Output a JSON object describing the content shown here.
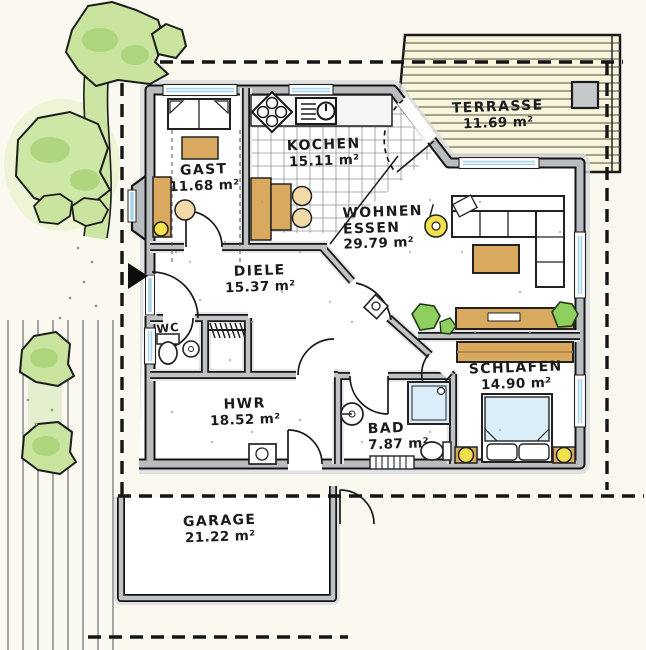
{
  "document": {
    "type": "architectural floor plan, hand-drawn marker style",
    "language": "de"
  },
  "rooms": [
    {
      "id": "terrasse",
      "label": "TERRASSE",
      "area": "11.69 m²"
    },
    {
      "id": "kochen",
      "label": "KOCHEN",
      "area": "15.11 m²"
    },
    {
      "id": "gast",
      "label": "GAST",
      "area": "11.68 m²"
    },
    {
      "id": "wohnen-essen",
      "label1": "WOHNEN /",
      "label2": "ESSEN",
      "area": "29.79 m²"
    },
    {
      "id": "diele",
      "label": "DIELE",
      "area": "15.37 m²"
    },
    {
      "id": "wc",
      "label": "WC"
    },
    {
      "id": "schlafen",
      "label": "SCHLAFEN",
      "area": "14.90 m²"
    },
    {
      "id": "hwr",
      "label": "HWR",
      "area": "18.52 m²"
    },
    {
      "id": "bad",
      "label": "BAD",
      "area": "7.87 m²"
    },
    {
      "id": "garage",
      "label": "GARAGE",
      "area": "21.22 m²"
    }
  ],
  "icons": [
    {
      "name": "entrance-arrow",
      "meaning": "main entrance marker"
    }
  ],
  "colors": {
    "paper": "#fbf8ef",
    "wall_fill": "#b9bdbf",
    "wall_outline": "#141414",
    "wall_halo": "#d9dcdd",
    "wood_furniture": "#d8a95e",
    "foliage": "#c8e49e",
    "foliage_dark": "#a7d276",
    "window_glass": "#a9d3e8",
    "lamp_yellow": "#f2e14c",
    "terrace_deck": "#f9f5da",
    "blanket_blue": "#d9eef8",
    "chair_beige": "#f2d9a8"
  }
}
